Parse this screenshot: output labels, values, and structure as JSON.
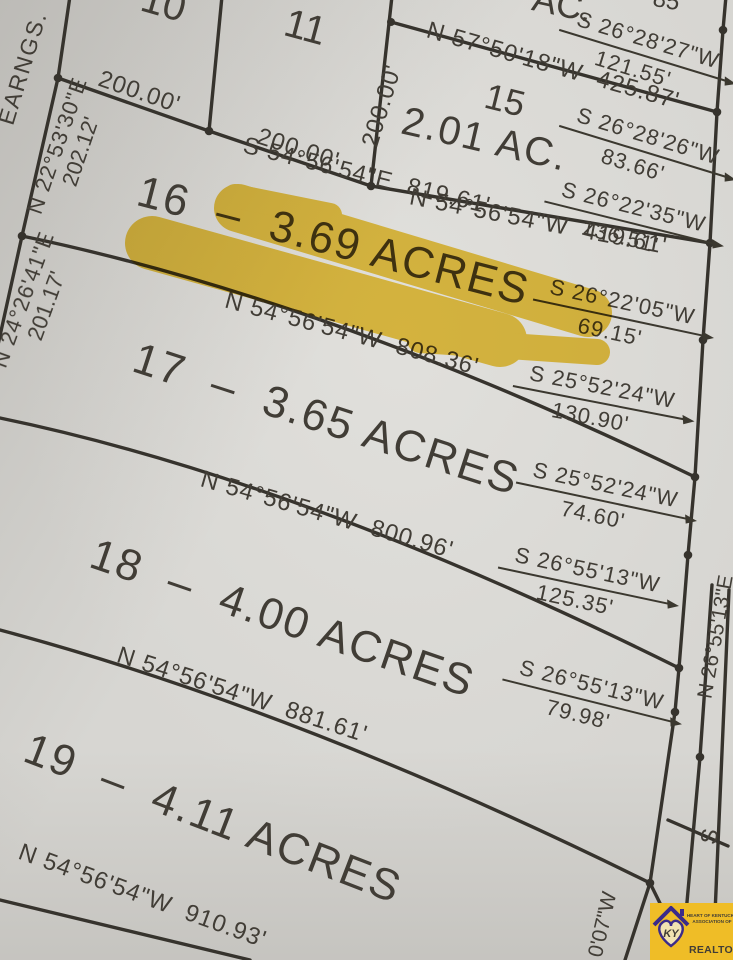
{
  "colors": {
    "paper": "#d7d6d2",
    "ink": "#36332d",
    "highlight": "#eec11f",
    "logo_gold": "#efbd27",
    "logo_purple": "#3b2b8a"
  },
  "corner_text": "EARNGS.",
  "top_lots": {
    "lot10": "10",
    "lot11": "11",
    "lot15_number": "15",
    "lot15_area": "2.01 AC.",
    "partial_area": "AC.",
    "partial_top_right": "85"
  },
  "dimensions": {
    "d200_1": "200.00'",
    "d200_2": "200.00'",
    "d200_3": "200.00'",
    "left_upper_bearing": "N 22°53'30\"E",
    "left_upper_dist": "202.12'",
    "left_lower_bearing": "N 24°26'41\"E",
    "left_lower_dist": "201.17'",
    "lot15_north": "N 57°50'18\"W  425.87'",
    "lot16_north": "S 54°56'54\"E  819.61'",
    "lot15_south": "N 54°56'54\"W  419.61'",
    "lot16_south": "N 54°56'54\"W  808.36'",
    "lot17_south": "N 54°56'54\"W  800.96'",
    "lot18_south": "N 54°56'54\"W  881.61'",
    "lot19_south": "N 54°56'54\"W  910.93'"
  },
  "right_frontage": [
    {
      "bearing": "S 26°28'27\"W",
      "distance": "121.55'"
    },
    {
      "bearing": "S 26°28'26\"W",
      "distance": "83.66'"
    },
    {
      "bearing": "S 26°22'35\"W",
      "distance": "136.51'"
    },
    {
      "bearing": "S 26°22'05\"W",
      "distance": "69.15'"
    },
    {
      "bearing": "S 25°52'24\"W",
      "distance": "130.90'"
    },
    {
      "bearing": "S 25°52'24\"W",
      "distance": "74.60'"
    },
    {
      "bearing": "S 26°55'13\"W",
      "distance": "125.35'"
    },
    {
      "bearing": "S 26°55'13\"W",
      "distance": "79.98'"
    }
  ],
  "road_labels": {
    "east_bearing": "N 26°55'13\"E",
    "south_s": "S",
    "partial_sw": "0'07\"W"
  },
  "lots": [
    {
      "label": "16  –  3.69 ACRES",
      "highlighted": true
    },
    {
      "label": "17  –  3.65 ACRES",
      "highlighted": false
    },
    {
      "label": "18  –  4.00 ACRES",
      "highlighted": false
    },
    {
      "label": "19  –  4.11 ACRES",
      "highlighted": false
    }
  ],
  "logo": {
    "region_code": "KY",
    "org_line1": "HEART OF KENTUCKY",
    "org_line2": "ASSOCIATION OF",
    "name": "REALTORS®"
  }
}
